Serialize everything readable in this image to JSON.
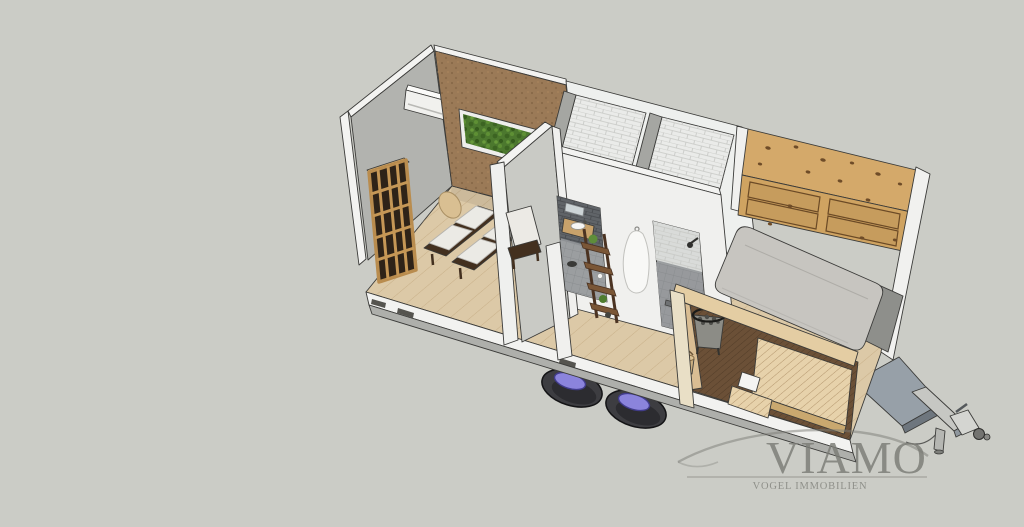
{
  "scene": {
    "description": "3D SketchUp-style cutaway rendering of a tiny house on a twin-axle trailer, roof and front wall removed, seen from above",
    "rooms": [
      "lounge with daybeds",
      "bathroom with shower and vanity",
      "bedroom with mattress and pine cabinets",
      "sauna deck"
    ]
  },
  "watermark": {
    "brand": "VIAMO",
    "subtitle": "VOGEL IMMOBILIEN"
  },
  "palette": {
    "background": "#cbccc6",
    "wall_gray": "#b2b3af",
    "wall_white": "#f0f0ee",
    "wall_edge": "#f3f3f1",
    "partition_gray": "#c9cac5",
    "cork": "#9b7a57",
    "moss": "#4c782e",
    "floor": "#dcc9a7",
    "tile": "#eaebe9",
    "dark_tile": "#606468",
    "bath_floor": "#9b9ea0",
    "pine": "#d4a96a",
    "cabinet": "#cfa361",
    "mattress": "#c7c5c0",
    "cushion": "#ebeae5",
    "bed_frame": "#43301f",
    "deck": "#6b5037",
    "bench": "#e7d2ab",
    "tire": "#3d3d41",
    "hub": "#8b84dc",
    "metal": "#c6c7c3",
    "logo": "#7b7c76"
  }
}
